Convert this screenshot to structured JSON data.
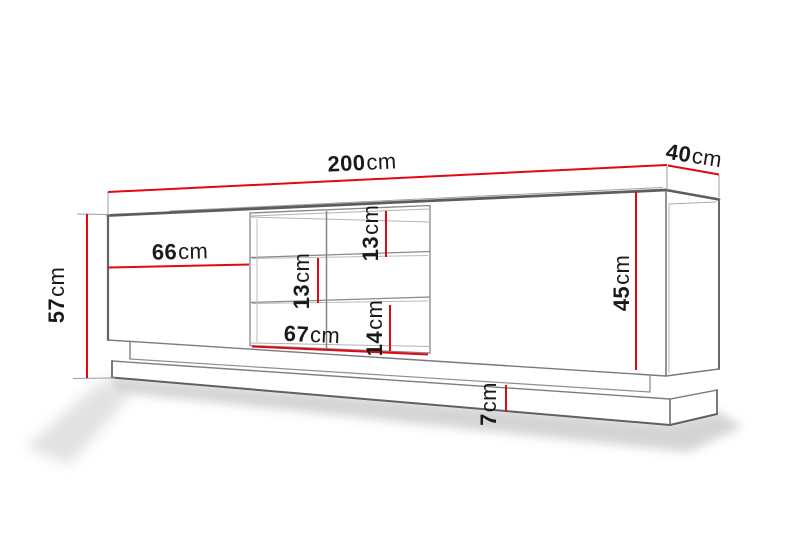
{
  "page": {
    "background": "#ffffff"
  },
  "diagram": {
    "type": "furniture-dimension-drawing",
    "subject": "TV cabinet / sideboard perspective drawing with dimension lines",
    "accent_color": "#e30613",
    "outline_color": "#666666",
    "text_color": "#1a1a1a",
    "dimensions": {
      "total_width": {
        "value": "200",
        "unit": "cm"
      },
      "depth": {
        "value": "40",
        "unit": "cm"
      },
      "total_height": {
        "value": "57",
        "unit": "cm"
      },
      "left_door_width": {
        "value": "66",
        "unit": "cm"
      },
      "niche_top_height": {
        "value": "13",
        "unit": "cm"
      },
      "niche_middle_height": {
        "value": "13",
        "unit": "cm"
      },
      "niche_bottom_height": {
        "value": "14",
        "unit": "cm"
      },
      "niche_width": {
        "value": "67",
        "unit": "cm"
      },
      "body_height": {
        "value": "45",
        "unit": "cm"
      },
      "plinth_height": {
        "value": "7",
        "unit": "cm"
      }
    }
  }
}
